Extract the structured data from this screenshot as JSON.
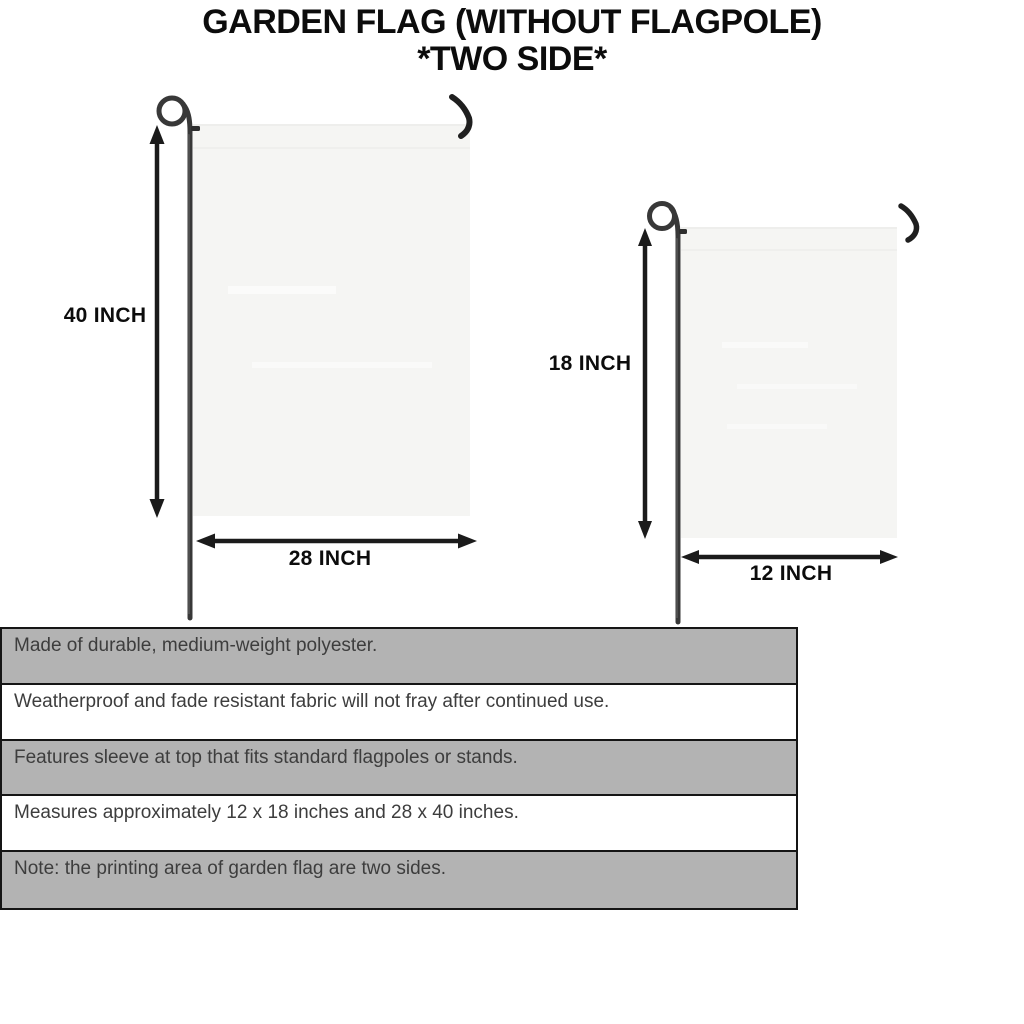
{
  "title": {
    "line1": "GARDEN FLAG (WITHOUT FLAGPOLE)",
    "line2": "*TWO SIDE*"
  },
  "diagrams": {
    "large_flag": {
      "height_label": "40 INCH",
      "width_label": "28 INCH"
    },
    "small_flag": {
      "height_label": "18 INCH",
      "width_label": "12 INCH"
    }
  },
  "features_table": {
    "rows": [
      {
        "text": "Made of durable, medium-weight polyester."
      },
      {
        "text": "Weatherproof and fade resistant fabric will not fray after continued use."
      },
      {
        "text": "Features sleeve at top that fits standard flagpoles or stands."
      },
      {
        "text": "Measures approximately 12 x 18 inches and 28 x 40 inches."
      },
      {
        "text": "Note: the printing area of garden flag are two sides."
      }
    ]
  },
  "colors": {
    "row_shaded": "#b3b3b3",
    "row_plain": "#ffffff",
    "table_border": "#151515",
    "flag_fill": "#f5f5f3",
    "pole": "#383838",
    "arrow": "#1b1b1b",
    "heading_text": "#0c0c0c",
    "table_text": "#3d3d3d",
    "background": "#ffffff"
  }
}
